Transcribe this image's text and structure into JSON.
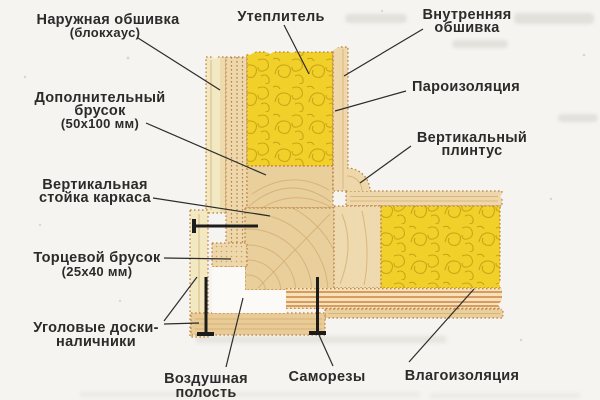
{
  "figure": {
    "type": "construction-detail-diagram",
    "subject": "Corner section of a timber frame wall (horizontal cut) with insulation layers"
  },
  "palette": {
    "bg": "#f5f4f0",
    "ink": "#2b2b2b",
    "yellow": "#f2d02a",
    "yellow_line": "#c49d10",
    "wood_light": "#f2e8c2",
    "wood": "#eed8ab",
    "wood_deep": "#e9cf9c",
    "grain": "#d2ab6e",
    "dot_border": "#b97f44",
    "stripe_orange": "#d49157",
    "stripe_light": "#f5e2b8",
    "cavity_white": "#fbfaf6",
    "screw": "#1c1c1c",
    "smudge": "#d7d4cd"
  },
  "labels": {
    "naruzhnaya": {
      "lines": [
        "Наружная обшивка",
        "(блокхаус)"
      ]
    },
    "uteplitel": {
      "text": "Утеплитель"
    },
    "vnutrennyaya": {
      "lines": [
        "Внутренняя",
        "обшивка"
      ]
    },
    "dopolnitelnyy": {
      "lines": [
        "Дополнительный",
        "брусок",
        "(50х100 мм)"
      ]
    },
    "paroizolyatsiya": {
      "text": "Пароизоляция"
    },
    "vertikalnyy_plintus": {
      "lines": [
        "Вертикальный",
        "плинтус"
      ]
    },
    "vertikalnaya_stoyka": {
      "lines": [
        "Вертикальная",
        "стойка каркаса"
      ]
    },
    "tortsevoy_brusok": {
      "lines": [
        "Торцевой брусок",
        "(25х40 мм)"
      ]
    },
    "uglovye_doski": {
      "lines": [
        "Уголовые доски-",
        "наличники"
      ]
    },
    "vozdushnaya_polost": {
      "lines": [
        "Воздушная",
        "полость"
      ]
    },
    "samorezy": {
      "text": "Саморезы"
    },
    "vlagoizolyatsiya": {
      "text": "Влагоизоляция"
    }
  }
}
